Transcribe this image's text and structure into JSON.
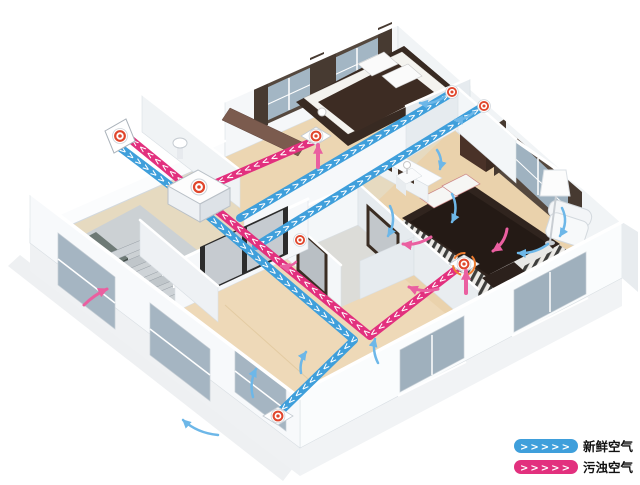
{
  "legend": {
    "items": [
      {
        "id": "fresh-air",
        "chevrons": ">>>>>",
        "label": "新鲜空气",
        "color": "#3f9fdb"
      },
      {
        "id": "exhaust-air",
        "chevrons": ">>>>>",
        "label": "污浊空气",
        "color": "#e2307e"
      }
    ]
  },
  "colors": {
    "fresh": "#3f9fdb",
    "exhaust": "#e2307e",
    "arrow_fresh": "#6db7e8",
    "arrow_exhaust": "#ea5fa0",
    "vent_ring": "#e0462c",
    "vent_dash": "#ef7d31",
    "chevron": "#ffffff"
  },
  "duct_style": {
    "chevron_char": ">",
    "band_width": 8,
    "chevron_step": 7.4
  },
  "ducts": [
    {
      "name": "fresh-air-trunk-duct",
      "type": "fresh",
      "path": "M 118 146 L 192 202 L 354 340 L 280 412"
    },
    {
      "name": "fresh-air-bedroom1-duct",
      "type": "fresh",
      "path": "M 240 218 L 450 94"
    },
    {
      "name": "fresh-air-bedroom2-duct",
      "type": "fresh",
      "path": "M 256 246 L 482 107"
    },
    {
      "name": "exhaust-air-main-duct",
      "type": "exhaust",
      "path": "M 463 264 L 370 336 L 124 134"
    },
    {
      "name": "exhaust-air-bedroom1-duct",
      "type": "exhaust",
      "path": "M 316 140 L 200 190"
    }
  ],
  "vents": [
    {
      "name": "outdoor-intake-exhaust-vent",
      "kind": "panel",
      "x": 120,
      "y": 136
    },
    {
      "name": "bedroom1-supply-vent",
      "kind": "wall",
      "x": 452,
      "y": 92
    },
    {
      "name": "bedroom2-supply-vent",
      "kind": "wall",
      "x": 484,
      "y": 106
    },
    {
      "name": "bedroom1-extract-vent",
      "kind": "floor",
      "x": 316,
      "y": 136
    },
    {
      "name": "master-extract-vent",
      "kind": "floor-ring",
      "x": 464,
      "y": 264
    },
    {
      "name": "living-room-supply-vent",
      "kind": "floor",
      "x": 278,
      "y": 416
    },
    {
      "name": "bathroom-extract-vent",
      "kind": "wall",
      "x": 300,
      "y": 240
    }
  ],
  "ventilation_unit": {
    "name": "heat-recovery-ventilator-unit",
    "x": 199,
    "y": 187
  },
  "flow_arrows": [
    {
      "name": "fresh-flow-arrow",
      "type": "fresh",
      "w": 2.5,
      "path": "M 444 97 Q 433 105 420 103"
    },
    {
      "name": "fresh-flow-arrow",
      "type": "fresh",
      "w": 2.5,
      "path": "M 474 112 Q 466 120 455 120"
    },
    {
      "name": "fresh-flow-arrow",
      "type": "fresh",
      "w": 2.5,
      "path": "M 390 206 Q 397 221 388 236"
    },
    {
      "name": "fresh-flow-arrow",
      "type": "fresh",
      "w": 2.5,
      "path": "M 452 194 Q 459 208 452 222"
    },
    {
      "name": "fresh-flow-arrow",
      "type": "fresh",
      "w": 2.5,
      "path": "M 562 208 Q 569 222 560 236"
    },
    {
      "name": "fresh-flow-arrow",
      "type": "fresh",
      "w": 2.5,
      "path": "M 548 244 Q 535 254 518 253"
    },
    {
      "name": "fresh-flow-arrow",
      "type": "fresh",
      "w": 2.5,
      "path": "M 437 150 Q 443 159 440 169"
    },
    {
      "name": "fresh-flow-arrow",
      "type": "fresh",
      "w": 2.5,
      "path": "M 253 397 Q 249 383 256 369"
    },
    {
      "name": "fresh-flow-arrow",
      "type": "fresh",
      "w": 2.5,
      "path": "M 218 435 Q 197 433 183 420"
    },
    {
      "name": "fresh-flow-arrow",
      "type": "fresh",
      "w": 2.5,
      "path": "M 301 373 Q 299 362 306 352"
    },
    {
      "name": "fresh-flow-arrow",
      "type": "fresh",
      "w": 2.5,
      "path": "M 378 363 Q 372 351 375 339"
    },
    {
      "name": "exhaust-flow-arrow",
      "type": "exhaust",
      "w": 4,
      "path": "M 318 167 L 318 145"
    },
    {
      "name": "exhaust-flow-arrow",
      "type": "exhaust",
      "w": 4,
      "path": "M 466 293 L 466 271"
    },
    {
      "name": "exhaust-flow-arrow",
      "type": "exhaust",
      "w": 3,
      "path": "M 431 237 Q 417 246 403 244"
    },
    {
      "name": "exhaust-flow-arrow",
      "type": "exhaust",
      "w": 3,
      "path": "M 507 229 Q 505 243 493 251"
    },
    {
      "name": "exhaust-flow-arrow",
      "type": "exhaust",
      "w": 3,
      "path": "M 438 289 Q 423 293 409 287"
    },
    {
      "name": "exhaust-flow-arrow",
      "type": "exhaust",
      "w": 3,
      "path": "M 84 305 Q 94 295 107 289"
    },
    {
      "name": "exhaust-flow-arrow",
      "type": "exhaust",
      "w": 2.5,
      "path": "M 296 262 Q 290 268 281 266"
    }
  ]
}
